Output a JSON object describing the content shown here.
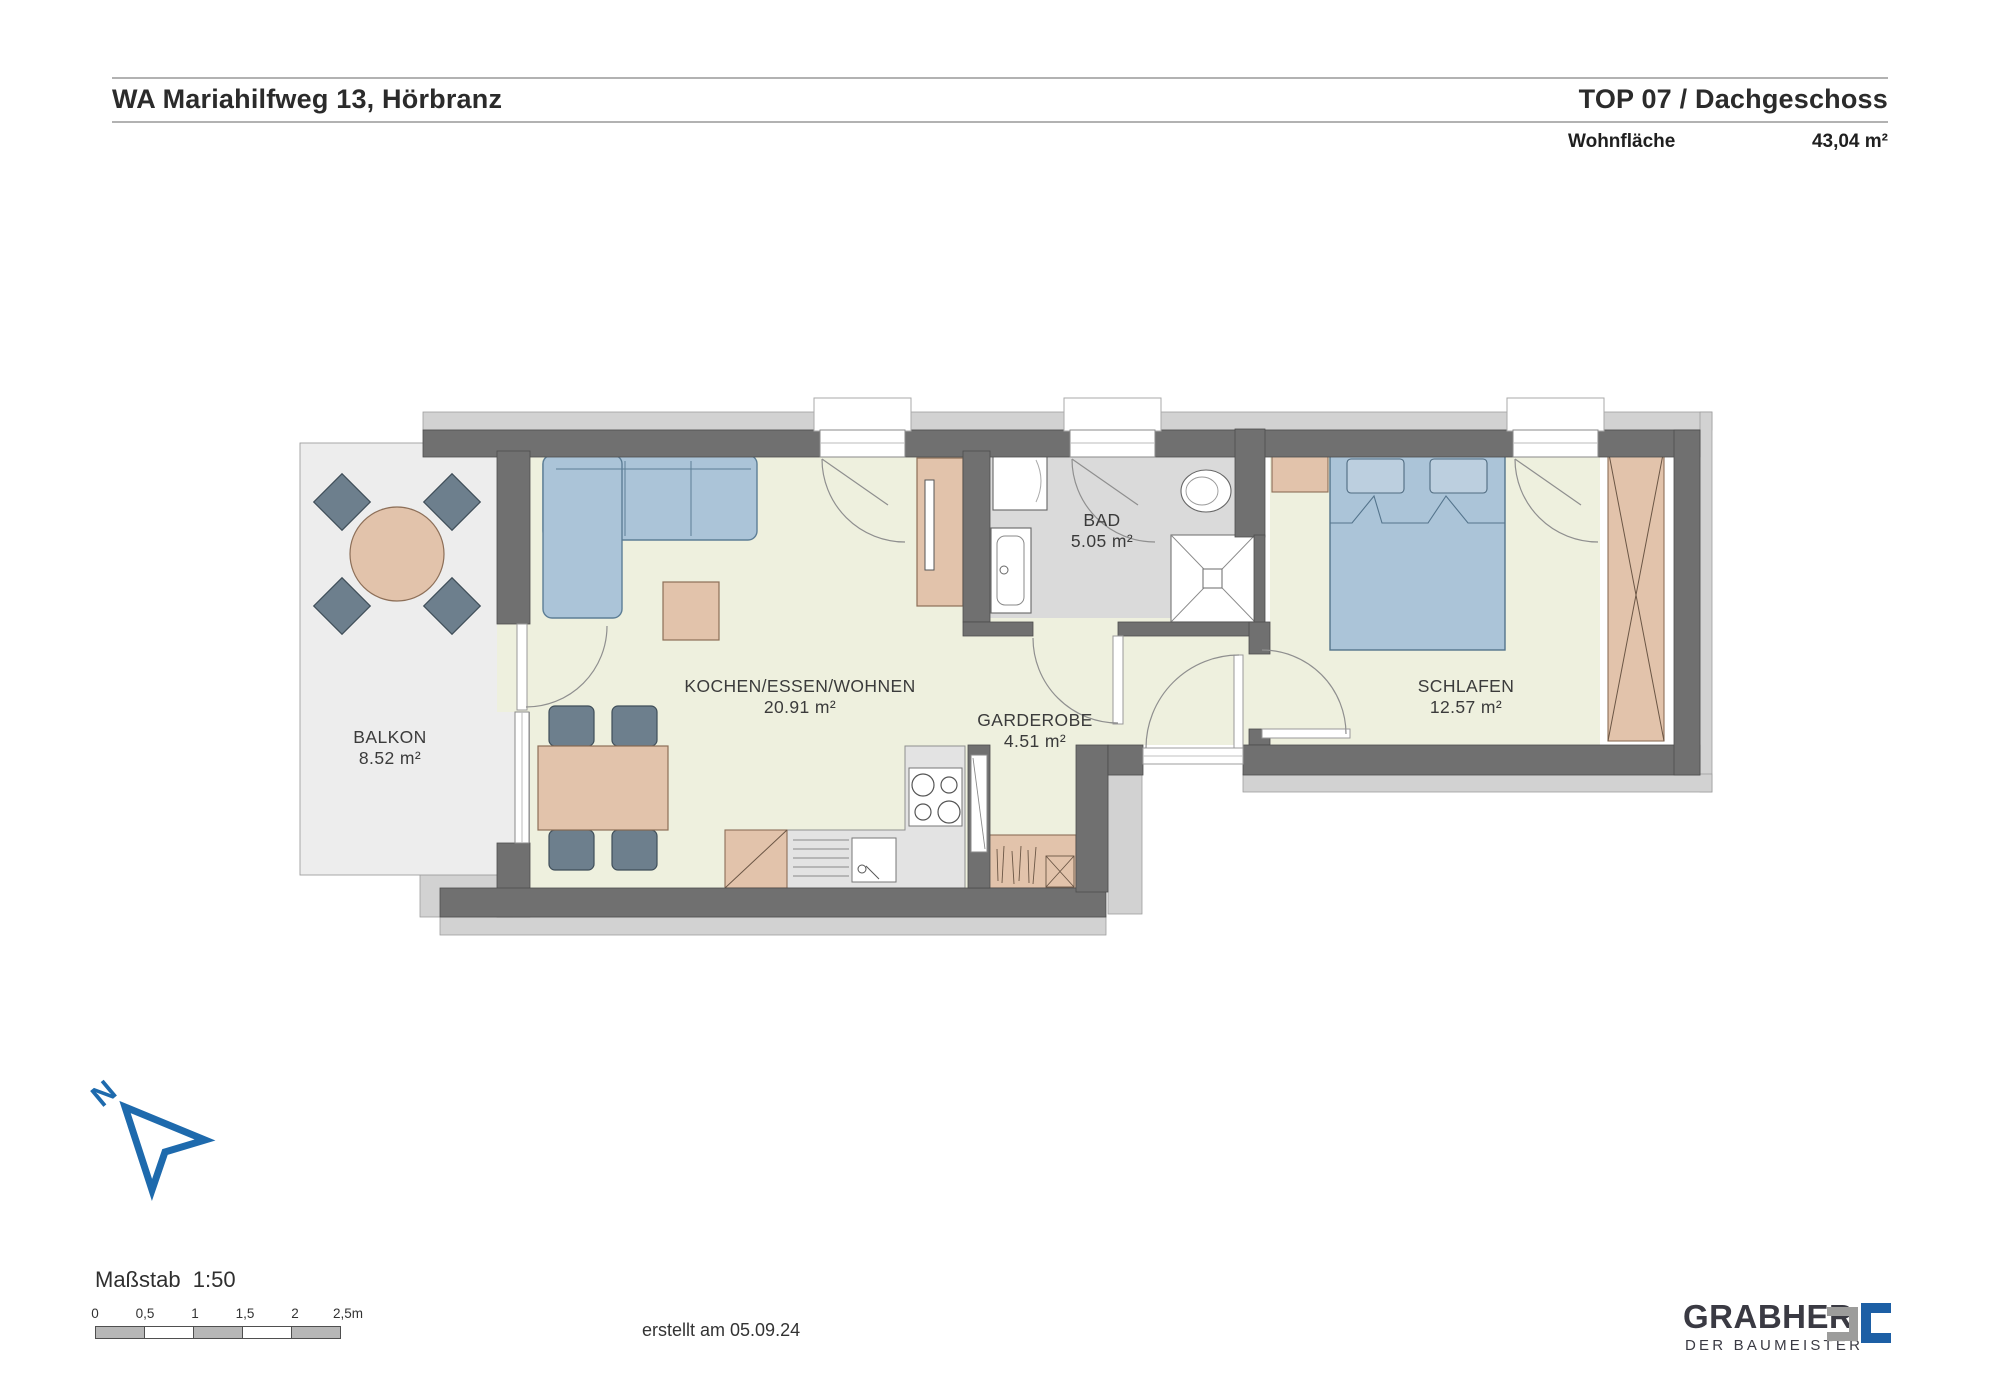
{
  "header": {
    "project_title": "WA Mariahilfweg 13, Hörbranz",
    "unit_title": "TOP 07 / Dachgeschoss",
    "area_label": "Wohnfläche",
    "area_value": "43,04 m²"
  },
  "plan": {
    "rooms": [
      {
        "name": "BALKON",
        "area": "8.52 m²"
      },
      {
        "name": "KOCHEN/ESSEN/WOHNEN",
        "area": "20.91 m²"
      },
      {
        "name": "BAD",
        "area": "5.05 m²"
      },
      {
        "name": "GARDEROBE",
        "area": "4.51 m²"
      },
      {
        "name": "SCHLAFEN",
        "area": "12.57 m²"
      }
    ]
  },
  "compass": {
    "label": "N"
  },
  "scalebar": {
    "title": "Maßstab  1:50",
    "ticks": [
      "0",
      "0,5",
      "1",
      "1,5",
      "2",
      "2,5m"
    ]
  },
  "footer": {
    "created_label": "erstellt am 05.09.24"
  },
  "brand": {
    "name": "GRABHER",
    "tagline": "DER BAUMEISTER"
  },
  "colors": {
    "accent_blue": "#1e6aad",
    "logo_blue": "#1d5fa5",
    "logo_gray": "#9c9c9b",
    "wall_dark": "#707070",
    "wall_light": "#d2d2d2",
    "floor_pale": "#eef0de",
    "floor_bath": "#dadada",
    "floor_balcony": "#ededed",
    "furniture_tan": "#e2c3ab",
    "furniture_blue": "#abc4d8",
    "chair_gray": "#6d7f8d"
  }
}
